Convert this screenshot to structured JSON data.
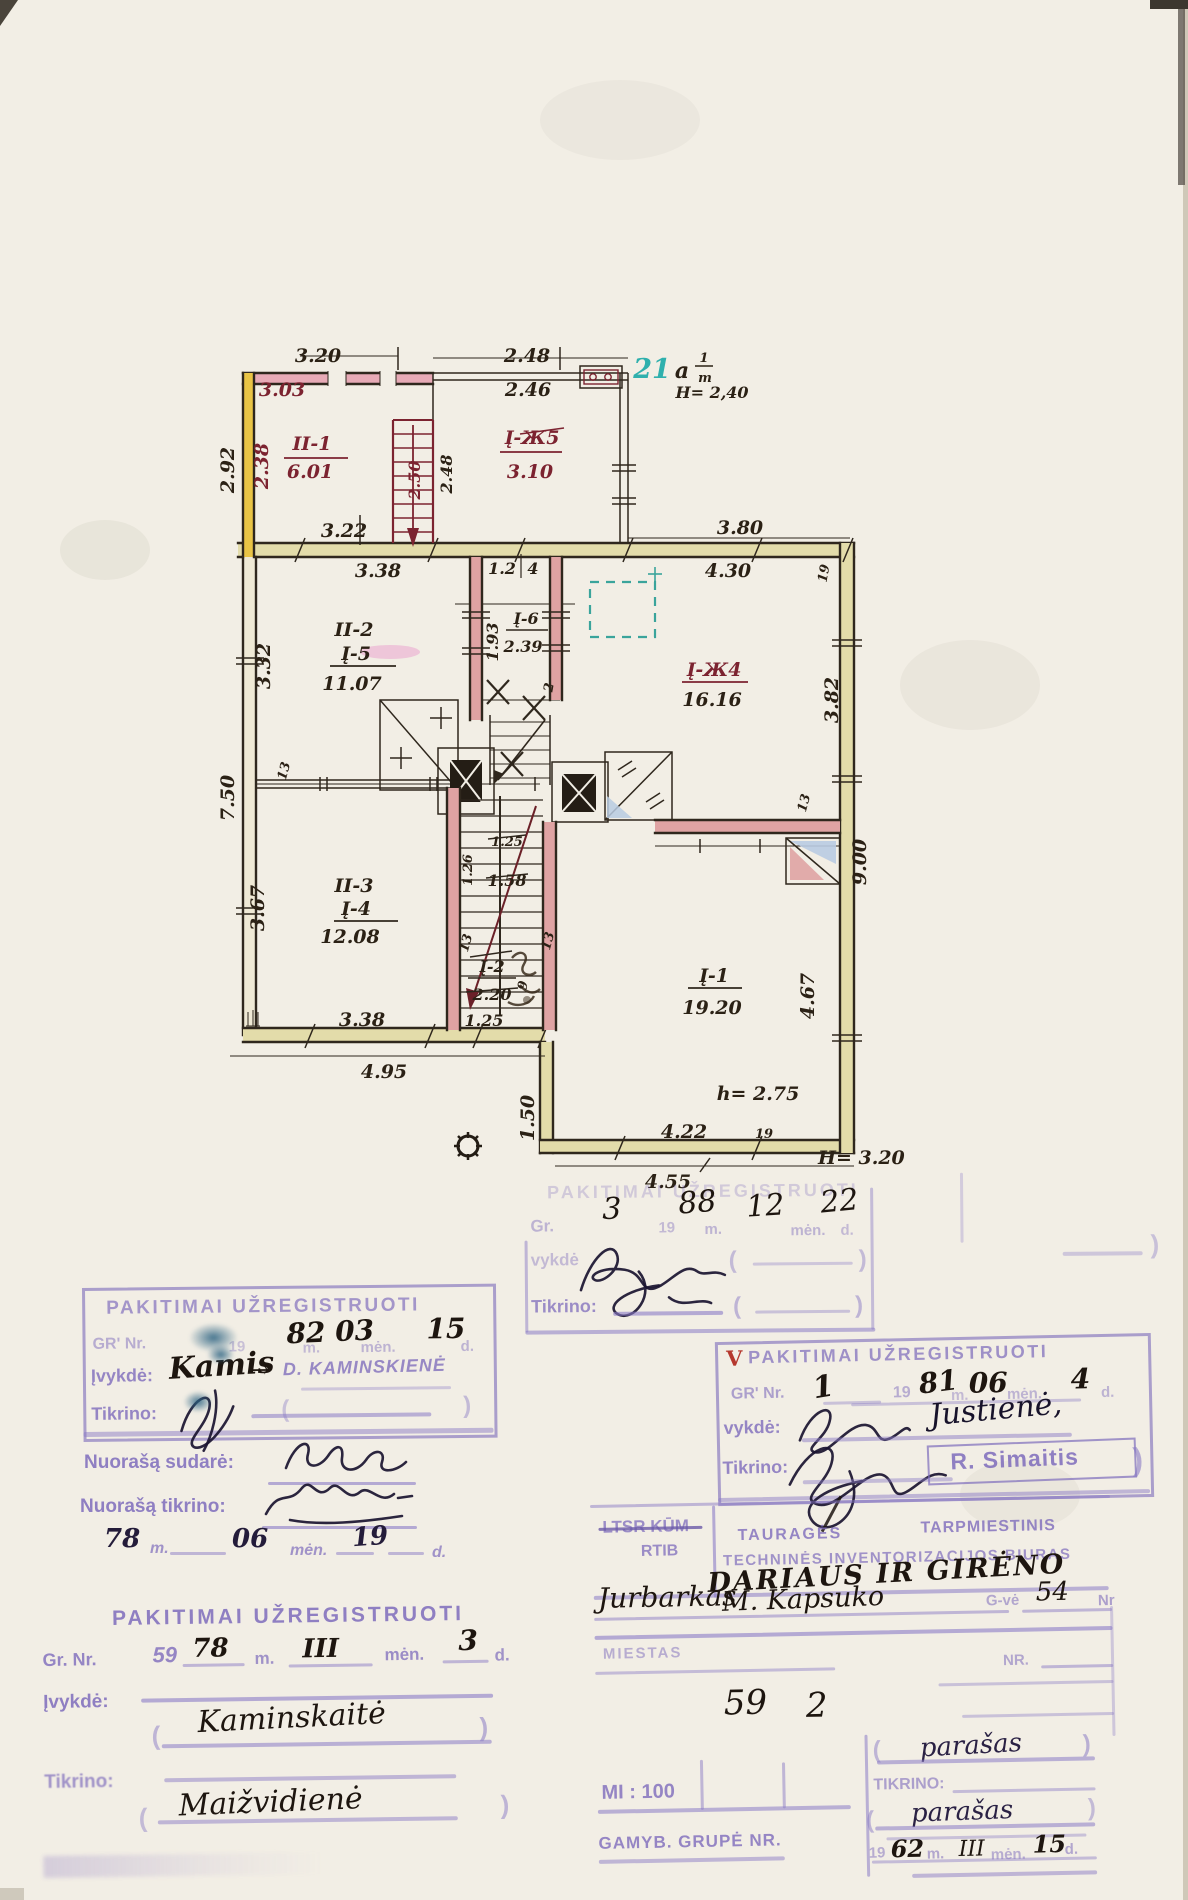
{
  "glyphs": {
    "open": "(",
    "close": ")"
  },
  "plan": {
    "unit": {
      "number": "21",
      "letter": "a",
      "frac_top": "1",
      "frac_bottom": "m",
      "height": "H= 2,40"
    },
    "rooms": {
      "ii1": {
        "name": "II-1",
        "area": "6.01"
      },
      "iz5": {
        "name": "Į-Ж5",
        "area": "3.10"
      },
      "ii2": {
        "name": "II-2",
        "alt": "Į-5",
        "area": "11.07"
      },
      "i6": {
        "name": "Į-6",
        "area": "2.39"
      },
      "iz4": {
        "name": "Į-Ж4",
        "area": "16.16"
      },
      "ii3": {
        "name": "II-3",
        "alt": "Į-4",
        "area": "12.08"
      },
      "i2": {
        "name": "Į-2",
        "area": "2.20"
      },
      "i1": {
        "name": "Į-1",
        "area": "19.20",
        "height": "h= 2.75"
      }
    },
    "dims": {
      "d320": "3.20",
      "d303": "3.03",
      "d292": "2.92",
      "d238": "2.38",
      "d250": "2.50",
      "d248v": "2.48",
      "d322": "3.22",
      "d248": "2.48",
      "d246": "2.46",
      "d338": "3.38",
      "d12": "1.2",
      "d4": "4",
      "d380": "3.80",
      "d430": "4.30",
      "d19a": "19",
      "d193": "1.93",
      "d332": "3.32",
      "d750": "7.50",
      "d367": "3.67",
      "d13a": "13",
      "d13b": "13",
      "d13c": "13",
      "d13d": "13",
      "d126": "1.26",
      "d125": "1.25",
      "d158": "1.58",
      "d2": "2",
      "d9": "9",
      "d382": "3.82",
      "d900": "9.00",
      "d467": "4.67",
      "d338b": "3.38",
      "d125b": "1.25",
      "d495": "4.95",
      "d150": "1.50",
      "d422": "4.22",
      "d19b": "19",
      "d455": "4.55",
      "dH": "H= 3.20"
    }
  },
  "stamp_mid": {
    "title": "PAKITIMAI UŽREGISTRUOTI",
    "gr": "Gr.",
    "year_prefix": "19",
    "m": "m.",
    "men": "mėn.",
    "d": "d.",
    "hw_nr": "3",
    "hw_year": "88",
    "hw_month": "12",
    "hw_day": "22",
    "vykde": "vykdė",
    "tikrino": "Tikrino:"
  },
  "stamp_left": {
    "title": "PAKITIMAI UŽREGISTRUOTI",
    "gr": "GR' Nr.",
    "year_prefix": "19",
    "m": "m.",
    "men": "mėn.",
    "d": "d.",
    "hw_date": "82 03",
    "hw_day": "15",
    "ivykde": "Įvykdė:",
    "hw_name": "Kamis",
    "hw_arrow": "→",
    "stamped_name": "D. KAMINSKIENĖ",
    "tikrino": "Tikrino:"
  },
  "copy_note": {
    "sudare": "Nuorašą sudarė:",
    "tikrino": "Nuorašą tikrino:",
    "hw_year": "78",
    "m": "m.",
    "hw_month": "06",
    "men": "mėn.",
    "hw_day": "19",
    "d": "d."
  },
  "stamp_right": {
    "v": "V",
    "title": "PAKITIMAI UŽREGISTRUOTI",
    "gr": "GR' Nr.",
    "hw_nr": "1",
    "year_prefix": "19",
    "hw_year": "81",
    "m": "m.",
    "hw_month": "06",
    "men": "mėn.",
    "hw_day": "4",
    "d": "d.",
    "vykde": "vykdė:",
    "hw_name": "Justienė,",
    "tikrino": "Tikrino:",
    "stamped_name": "R. Simaitis"
  },
  "stamp_bottom": {
    "title": "PAKITIMAI UŽREGISTRUOTI",
    "gr": "Gr. Nr.",
    "nr": "59",
    "hw_year": "78",
    "m": "m.",
    "hw_month": "III",
    "men": "mėn.",
    "hw_day": "3",
    "d": "d.",
    "ivykde": "Įvykdė:",
    "hw_name": "Kaminskaitė",
    "tikrino": "Tikrino:",
    "hw_name2": "Maižvidienė"
  },
  "bureau": {
    "org_tl": "LTSR KŪM",
    "org_tl2": "RTIB",
    "org_tr1": "TAURAGĖS",
    "org_tr2": "TARPMIESTINIS",
    "org_tr3": "TECHNINĖS INVENTORIZACIJOS BIURAS",
    "hw_street": "DARIAUS IR GIRĖNO",
    "hw_city": "Jurbarkas",
    "hw_street_old": "M. Kapsuko",
    "gve": "G-vė",
    "hw_house": "54",
    "nr_small": "Nr",
    "miestas": "MIESTAS",
    "nr": "NR.",
    "hw_num1": "59",
    "hw_num2": "2",
    "scale": "MI : 100",
    "tikrino": "TIKRINO:",
    "parasas1": "parašas",
    "parasas2": "parašas",
    "gamyb": "GAMYB. GRUPĖ NR.",
    "year_prefix": "19",
    "hw_year": "62",
    "m": "m.",
    "hw_month": "III",
    "men": "mėn.",
    "hw_day": "15",
    "d": "d."
  }
}
